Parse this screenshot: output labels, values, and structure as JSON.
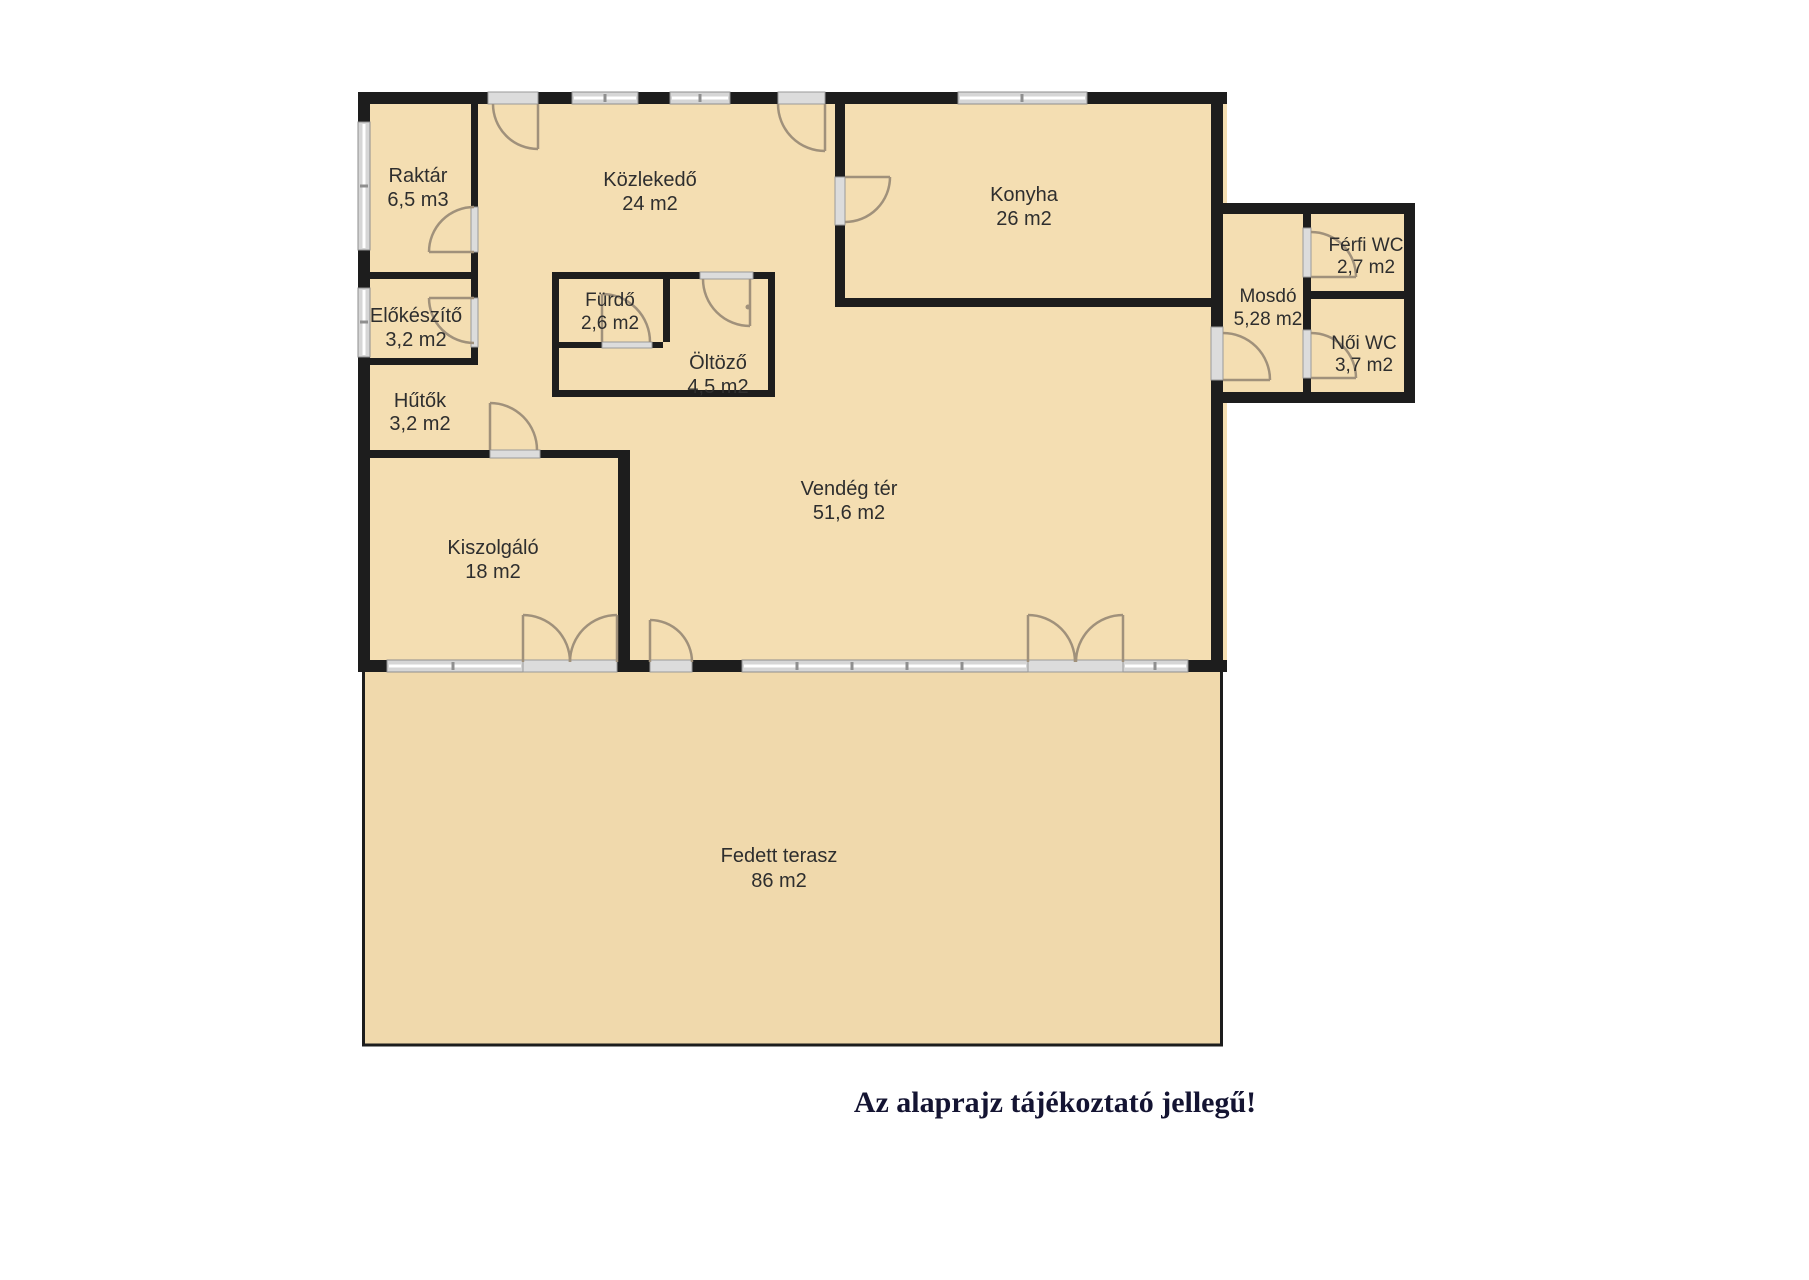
{
  "caption": "Az alaprajz tájékoztató jellegű!",
  "colors": {
    "floor": "#f4deb2",
    "terrace": "#f0d9ac",
    "wall": "#1d1d1d",
    "door": "#a0917b",
    "label": "#2e2e2e",
    "caption": "#141432"
  },
  "rooms": {
    "raktar": {
      "name": "Raktár",
      "area": "6,5 m3"
    },
    "kozlekedo": {
      "name": "Közlekedő",
      "area": "24 m2"
    },
    "konyha": {
      "name": "Konyha",
      "area": "26 m2"
    },
    "ferfiwc": {
      "name": "Férfi WC",
      "area": "2,7 m2"
    },
    "mosdo": {
      "name": "Mosdó",
      "area": "5,28 m2"
    },
    "elokeszito": {
      "name": "Előkészítő",
      "area": "3,2 m2"
    },
    "furdo": {
      "name": "Fürdő",
      "area": "2,6 m2"
    },
    "noiwc": {
      "name": "Női WC",
      "area": "3,7 m2"
    },
    "oltozo": {
      "name": "Öltöző",
      "area": "4,5 m2"
    },
    "hutok": {
      "name": "Hűtők",
      "area": "3,2 m2"
    },
    "kiszolgalo": {
      "name": "Kiszolgáló",
      "area": "18 m2"
    },
    "vendegter": {
      "name": "Vendég tér",
      "area": "51,6 m2"
    },
    "terasz": {
      "name": "Fedett terasz",
      "area": "86 m2"
    }
  }
}
